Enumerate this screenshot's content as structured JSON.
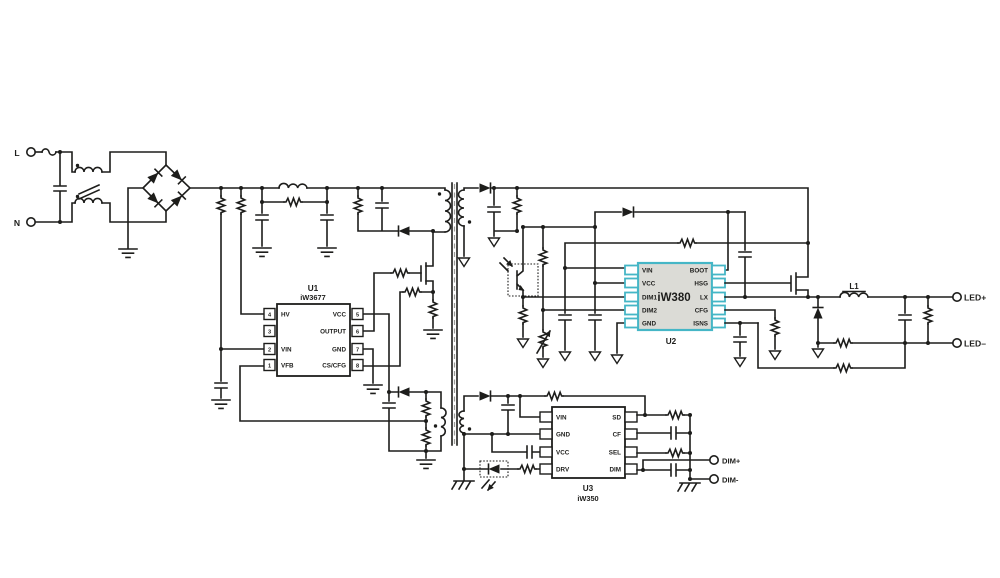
{
  "schematic": {
    "terminals": {
      "line": "L",
      "neutral": "N",
      "led_plus": "LED+",
      "led_minus": "LED–",
      "dim_plus": "DIM+",
      "dim_minus": "DIM-"
    },
    "labels": {
      "output_inductor": "L1"
    },
    "u1": {
      "ref": "U1",
      "part": "iW3677",
      "left_pins": [
        {
          "num": "4",
          "name": "HV"
        },
        {
          "num": "3",
          "name": ""
        },
        {
          "num": "2",
          "name": "VIN"
        },
        {
          "num": "1",
          "name": "VFB"
        }
      ],
      "right_pins": [
        {
          "num": "5",
          "name": "VCC"
        },
        {
          "num": "6",
          "name": "OUTPUT"
        },
        {
          "num": "7",
          "name": "GND"
        },
        {
          "num": "8",
          "name": "CS/CFG"
        }
      ]
    },
    "u2": {
      "ref": "U2",
      "part": "iW380",
      "left_pins": [
        "VIN",
        "VCC",
        "DIM1",
        "DIM2",
        "GND"
      ],
      "right_pins": [
        "BOOT",
        "HSG",
        "LX",
        "CFG",
        "ISNS"
      ]
    },
    "u3": {
      "ref": "U3",
      "part": "iW350",
      "left_pins": [
        "VIN",
        "GND",
        "VCC",
        "DRV"
      ],
      "right_pins": [
        "SD",
        "CF",
        "SEL",
        "DIM"
      ]
    },
    "colors": {
      "wire": "#1d1d1b",
      "u2_accent": "#45b6c6",
      "u2_body": "#dbdbd6",
      "background": "#ffffff"
    }
  }
}
